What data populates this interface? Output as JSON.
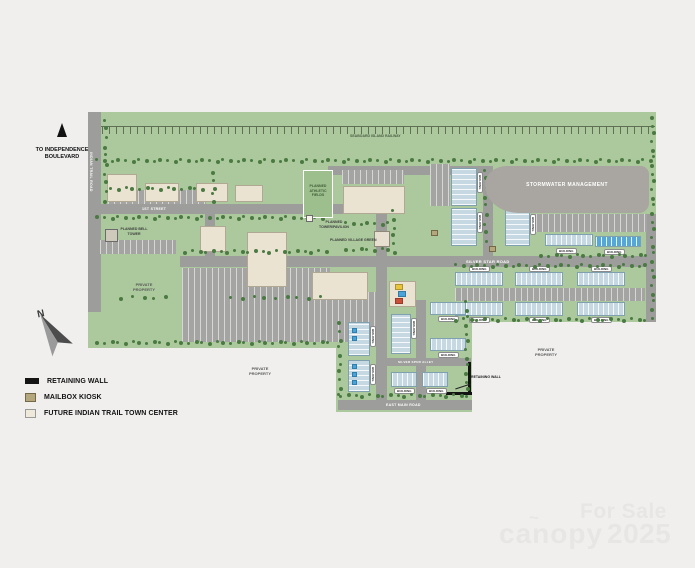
{
  "map": {
    "to_note": "TO INDEPENDENCE BOULEVARD",
    "compass": "N",
    "roads": {
      "railway": "SEABOARD ISLAND RAILWAY",
      "indian_trail": "INDIAN TRAIL ROAD",
      "first_street": "1ST STREET",
      "silver_star": "SILVER STAR ROAD",
      "silver_spur_alley": "SILVER SPUR ALLEY",
      "east_main": "EAST MAIN ROAD"
    },
    "labels": {
      "stormwater": "STORMWATER MANAGEMENT",
      "athletic_fields": "PLANNED ATHLETIC FIELDS",
      "tower_pavilion": "PLANNED TOWER/PAVILION",
      "village_green": "PLANNED VILLAGE GREEN",
      "bell_tower": "PLANNED BELL TOWER",
      "private_property": "PRIVATE PROPERTY",
      "retaining_wall": "RETAINING WALL",
      "building": "BUILDING"
    }
  },
  "legend": {
    "items": [
      {
        "label": "RETAINING WALL",
        "swatch": "retaining-wall"
      },
      {
        "label": "MAILBOX KIOSK",
        "swatch": "mailbox-kiosk"
      },
      {
        "label": "FUTURE INDIAN TRAIL TOWN CENTER",
        "swatch": "town-center"
      }
    ]
  },
  "watermark": {
    "for_sale": "For Sale",
    "brand": "canopy",
    "year": "2025"
  },
  "colors": {
    "site_green": "#abc99c",
    "road_gray": "#9d9d9b",
    "townhome_blue": "#c6d8e2",
    "highlight_blue": "#55a7d8",
    "town_center_cream": "#ebe3d1",
    "stormwater_gray": "#a9a5a0",
    "kiosk_tan": "#b4a77d",
    "retaining_wall_black": "#141414"
  }
}
